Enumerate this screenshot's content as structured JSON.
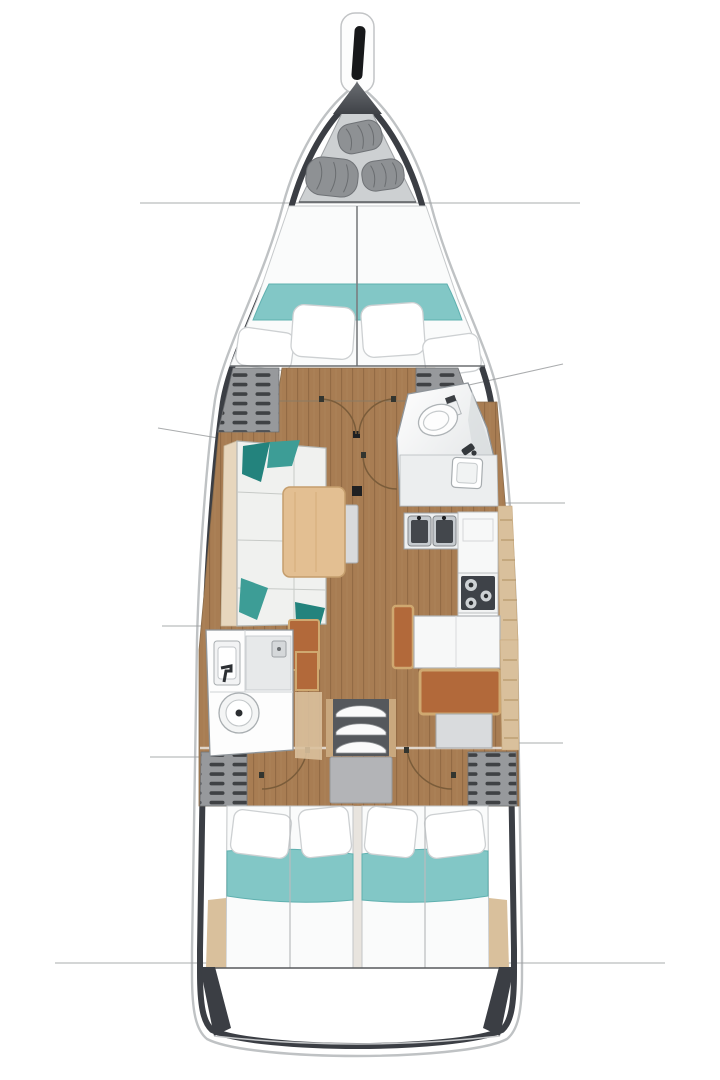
{
  "image": {
    "kind": "sailboat-interior-floorplan",
    "view": "top-down deck plan, bow at top, stern at bottom"
  },
  "legend": {
    "rooms": [
      "forepeak sail locker",
      "forward cabin v-berth",
      "salon",
      "forward head",
      "galley",
      "navigation station",
      "aft head",
      "companionway",
      "aft cabin port",
      "aft cabin starboard",
      "stern lazarette"
    ],
    "furniture": [
      "anchor fitting",
      "rolled sails",
      "double berth",
      "pillows",
      "teal bedspread",
      "l-sofa with teal cushions",
      "folding saloon table",
      "mast post",
      "door swing arcs",
      "toilet",
      "washbasin",
      "double galley sink",
      "three-burner stove",
      "chart table",
      "orange nav seat",
      "companionway steps",
      "engine box",
      "louvered lockers"
    ]
  },
  "colors": {
    "background": "#ffffff",
    "hull_outline": "#bfc2c4",
    "hull_wall": "#3b3e44",
    "section_line": "#9c9ea0",
    "locker_bg": "#cdd0d2",
    "bulkhead_dark": "#4c4f54",
    "sail_gray": "#8e9194",
    "sail_edge": "#6f7276",
    "mattress": "#fafbfb",
    "bedding_teal": "#82c7c6",
    "bedding_teal_edge": "#5fb0af",
    "pillow_stroke": "#cdd0d2",
    "floor_wood": "#a87d53",
    "floor_plank_line": "#936b45",
    "floor_plank_light": "#b28a5e",
    "sofa": "#f0f1ef",
    "sofa_edge": "#b3b6b3",
    "backrest": "#e7d6bd",
    "cushion_teal": "#3d9d96",
    "cushion_teal_dark": "#23837d",
    "table_wood": "#e3bf92",
    "table_wood_edge": "#c59e6d",
    "leaf_gray": "#d9dadc",
    "trim_wood": "#d9c09c",
    "trim_wood_line": "#b08f60",
    "locker_gray": "#97999c",
    "locker_hatch": "#3f4144",
    "seat_orange": "#b2693a",
    "seat_frame": "#cfa870",
    "fixture_white": "#f7f8f8",
    "room_stroke": "#8f959a",
    "counter_gray": "#eceeef",
    "shower_gray": "#e7e9ea",
    "sink_steel": "#c6cbcf",
    "sink_dark": "#43474c",
    "stove_dark": "#3e4248",
    "burner_light": "#cdd1d4",
    "engine_gray": "#b3b4b7",
    "rail_wood": "#c9a87e",
    "step_dark": "#55585c",
    "arc_line": "#7a5c3a",
    "dark_marker": "#1f2022"
  }
}
